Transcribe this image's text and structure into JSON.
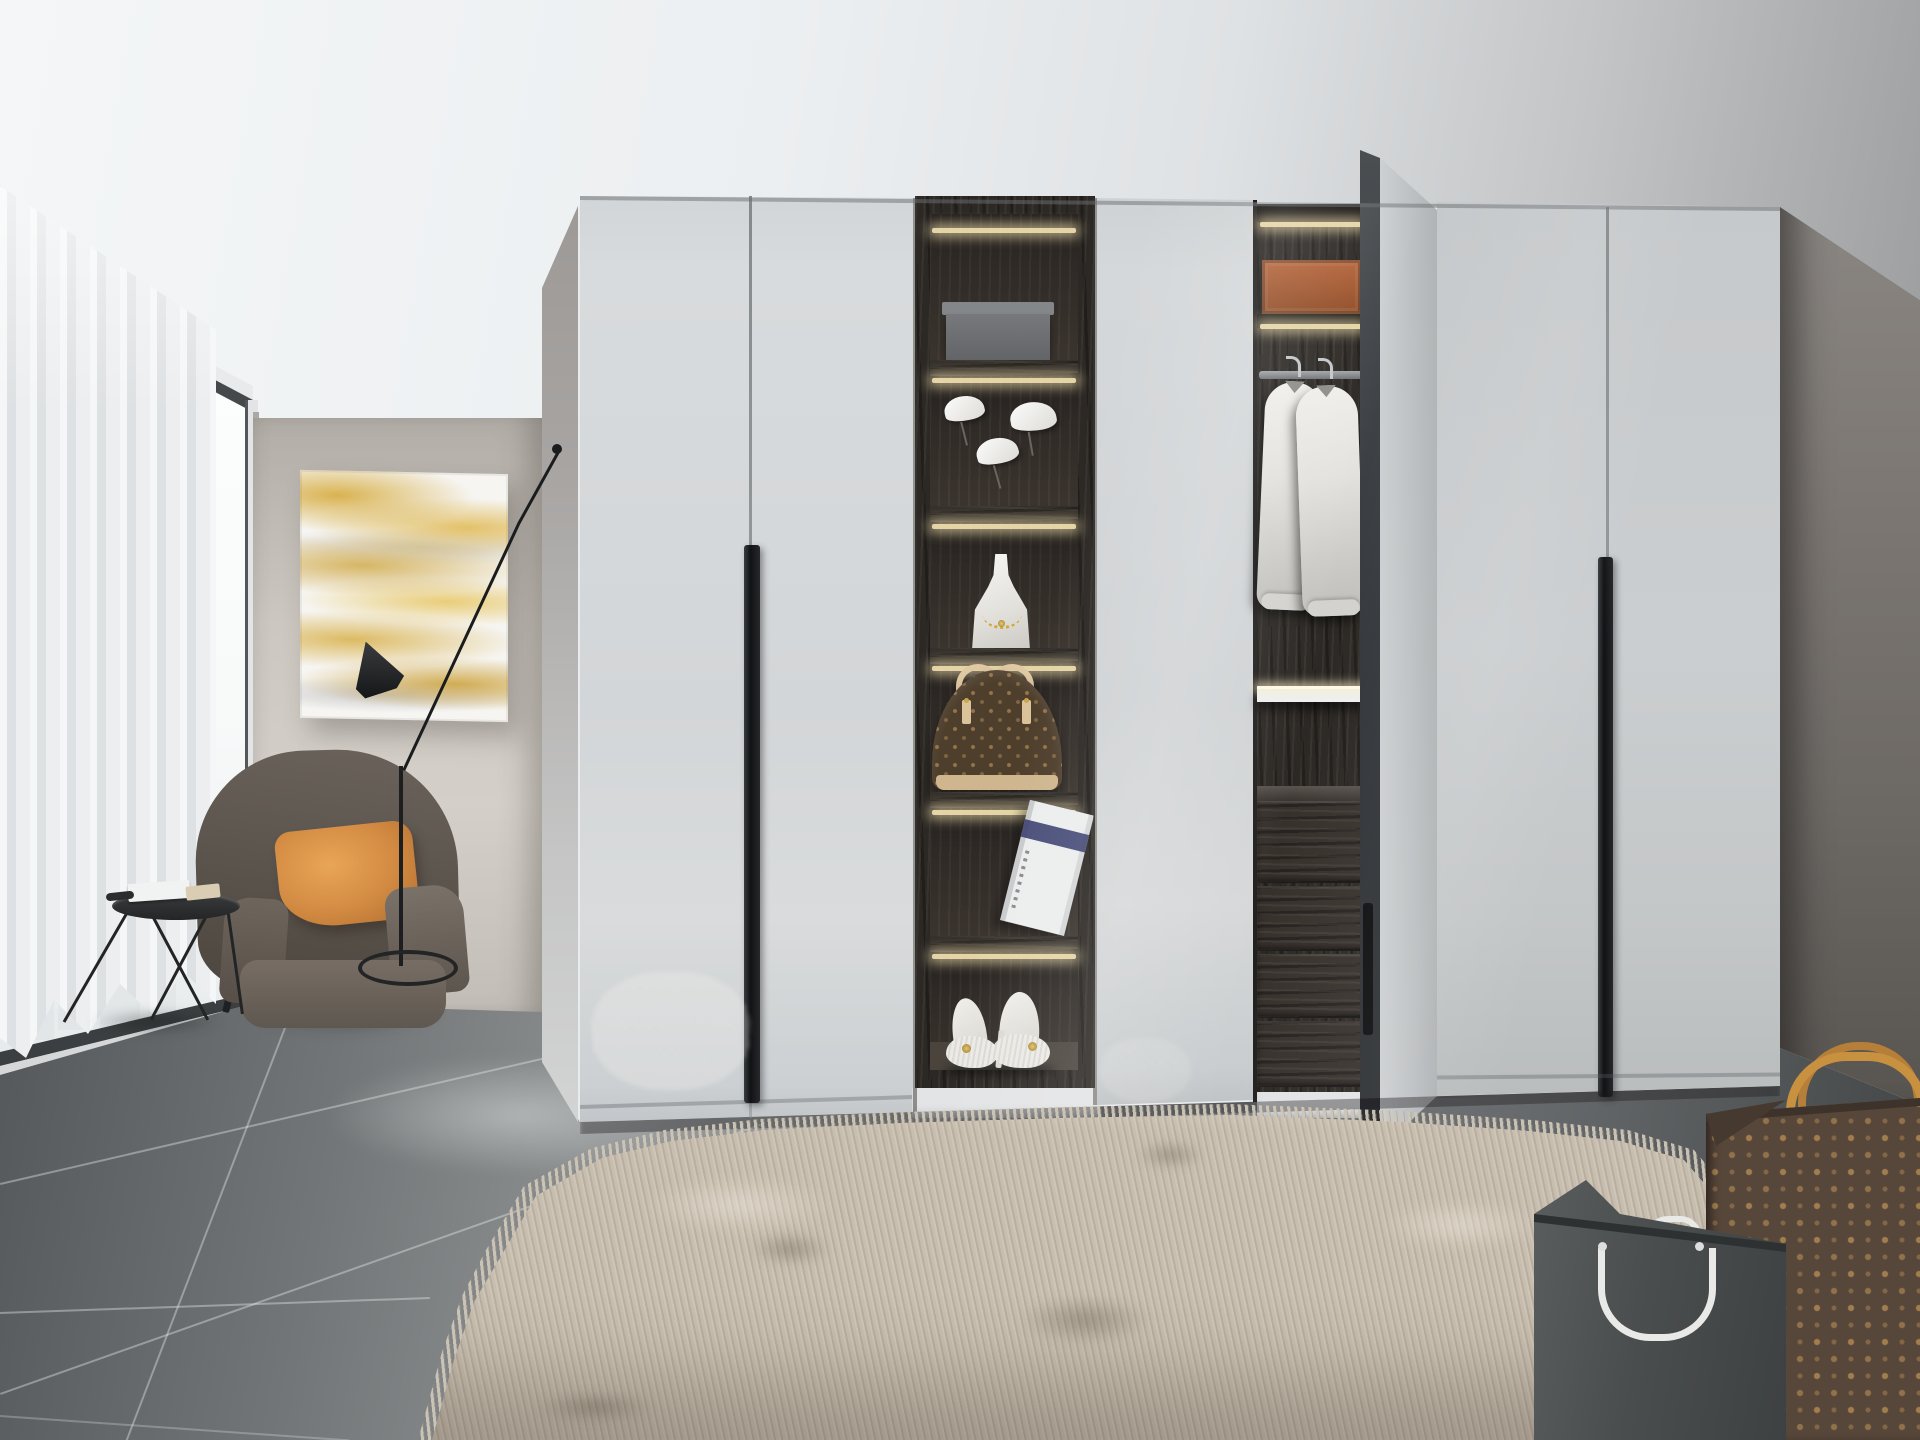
{
  "scene": {
    "description": "3D interior render: modern bedroom corner with white high-gloss wardrobe, open display shelving, wingback armchair by a floor-to-ceiling window, shag rug and designer shopping bags",
    "objects": {
      "window": "floor-to-ceiling corner window with sheer white curtain",
      "painting": "abstract gold marble wall art",
      "floor_lamp": "black angled floor lamp with cone shade",
      "armchair": "brown fabric wingback armchair",
      "pillow": "orange throw pillow",
      "side_table": "black wire side table with open book and sunglasses",
      "wardrobe": "white high-gloss wardrobe with long black handles",
      "shelf_items": [
        "grey storage box",
        "white bird figurines",
        "jewelry bust with gold necklace",
        "monogram dome handbag",
        "white book with navy band",
        "white high-heel shoes"
      ],
      "open_section_items": [
        "leather storage box",
        "two white shirts on hangers",
        "dark wood drawers"
      ],
      "rug": "beige shag rug",
      "bags": [
        "brown monogram shopping bag with tan handles",
        "grey shopping bag with white rope handle"
      ]
    },
    "colors": {
      "ceiling": "#e9ecee",
      "wall_back": "#cdc7c1",
      "wall_right": "#6d6965",
      "door_grey": "#d3d6d8",
      "door_seam": "#8e9294",
      "handle_black": "#111315",
      "wood_dark": "#2c2824",
      "led_warm": "#f0dfae",
      "floor_tile": "#7c7f81",
      "grout": "#dadddd",
      "rug_beige": "#c6bcae",
      "rug_shadow": "#8e877b",
      "chair_brown": "#5f5851",
      "pillow_orange": "#d28a42",
      "gold_swirl": "#d4a733",
      "monogram_brown": "#57463a",
      "monogram_motif": "#9c7a4e",
      "handle_tan": "#c8913f",
      "bag_grey": "#4a4d4e",
      "rope_white": "#e9e9e7",
      "shirt_white": "#e9e8e5",
      "window_glass": "#fbfcfd",
      "curtain": "#eef0f1",
      "bust_white": "#efeeea",
      "box_grey": "#6d7072",
      "box_leather": "#9b5228",
      "book_navy": "#3a3e6e"
    }
  }
}
